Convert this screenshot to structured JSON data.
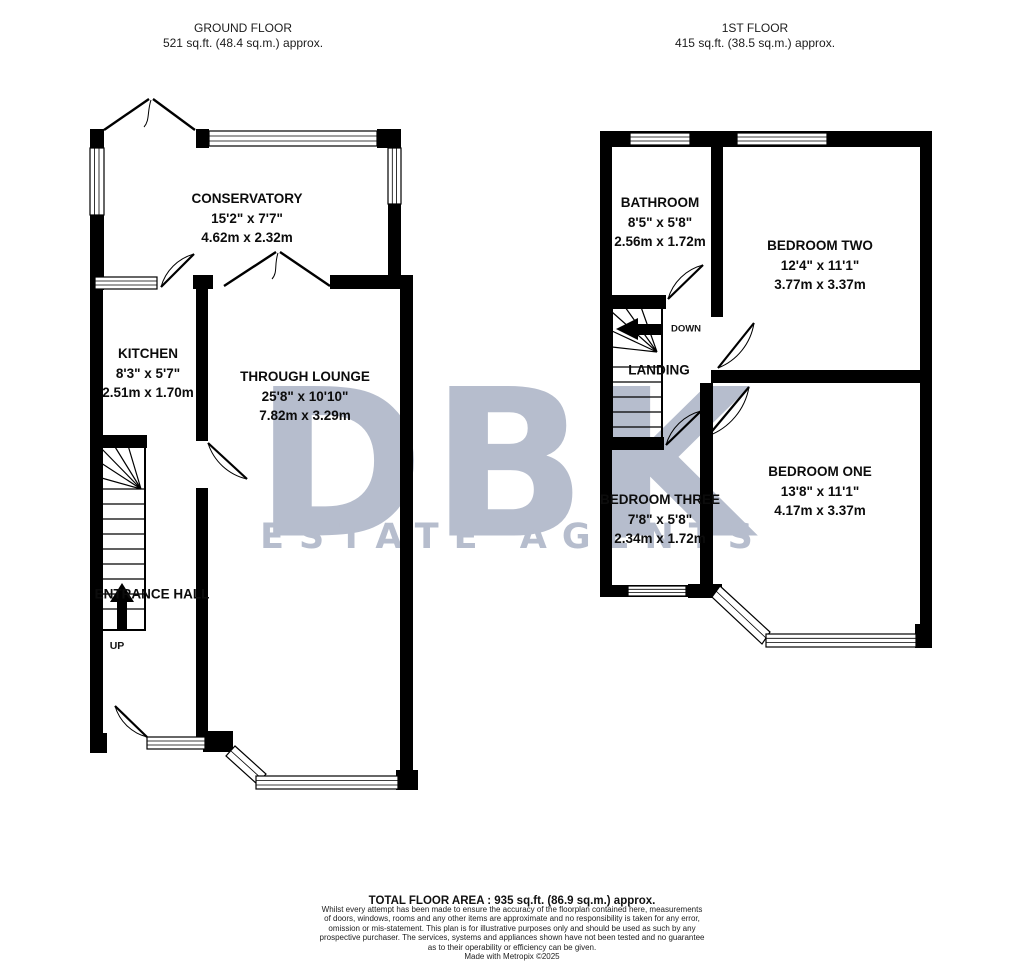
{
  "colors": {
    "wall": "#000000",
    "watermark": "#b6bdcd",
    "background": "#ffffff"
  },
  "watermark": {
    "title": "DBK",
    "subtitle": "ESTATE AGENTS"
  },
  "ground_floor": {
    "title": "GROUND FLOOR",
    "area": "521 sq.ft. (48.4 sq.m.) approx.",
    "rooms": {
      "conservatory": {
        "name": "CONSERVATORY",
        "imperial": "15'2\" x 7'7\"",
        "metric": "4.62m x 2.32m"
      },
      "kitchen": {
        "name": "KITCHEN",
        "imperial": "8'3\" x 5'7\"",
        "metric": "2.51m x 1.70m"
      },
      "through_lounge": {
        "name": "THROUGH LOUNGE",
        "imperial": "25'8\" x 10'10\"",
        "metric": "7.82m x 3.29m"
      },
      "entrance_hall": {
        "name": "ENTRANCE HALL"
      }
    },
    "stairs": {
      "direction": "UP"
    }
  },
  "first_floor": {
    "title": "1ST FLOOR",
    "area": "415 sq.ft. (38.5 sq.m.) approx.",
    "rooms": {
      "bathroom": {
        "name": "BATHROOM",
        "imperial": "8'5\" x 5'8\"",
        "metric": "2.56m x 1.72m"
      },
      "bedroom_two": {
        "name": "BEDROOM TWO",
        "imperial": "12'4\" x 11'1\"",
        "metric": "3.77m x 3.37m"
      },
      "bedroom_one": {
        "name": "BEDROOM ONE",
        "imperial": "13'8\" x 11'1\"",
        "metric": "4.17m x 3.37m"
      },
      "bedroom_three": {
        "name": "BEDROOM THREE",
        "imperial": "7'8\" x 5'8\"",
        "metric": "2.34m x 1.72m"
      },
      "landing": {
        "name": "LANDING"
      }
    },
    "stairs": {
      "direction": "DOWN"
    }
  },
  "footer": {
    "total_area": "TOTAL FLOOR AREA : 935 sq.ft. (86.9 sq.m.) approx.",
    "disclaimer": [
      "Whilst every attempt has been made to ensure the accuracy of the floorplan contained here, measurements",
      "of doors, windows, rooms and any other items are approximate and no responsibility is taken for any error,",
      "omission or mis-statement. This plan is for illustrative purposes only and should be used as such by any",
      "prospective purchaser. The services, systems and appliances shown have not been tested and no guarantee",
      "as to their operability or efficiency can be given."
    ],
    "credit": "Made with Metropix ©2025"
  }
}
